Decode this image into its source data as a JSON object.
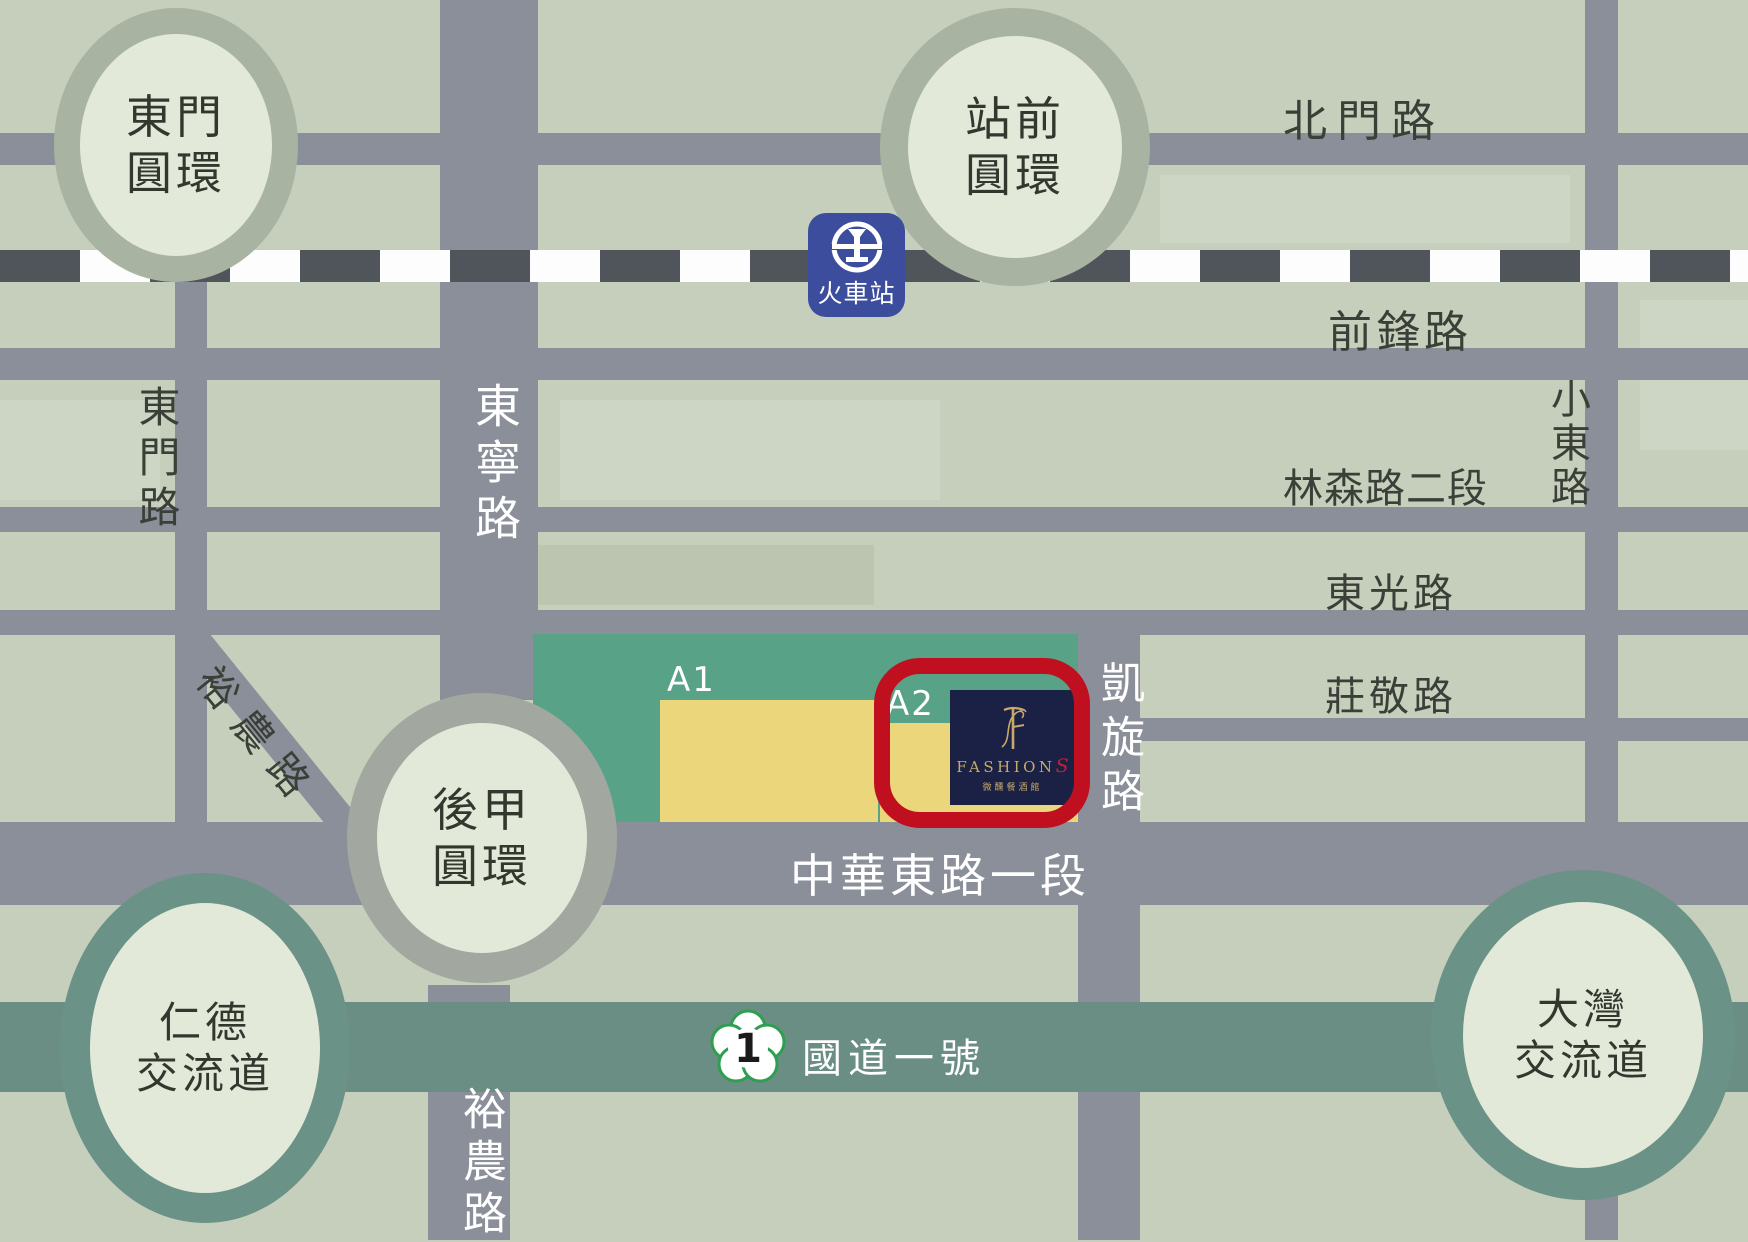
{
  "map_title": "FASHIONS hotel location map, Tainan",
  "colors": {
    "background": "#C6CFBC",
    "road_gray": "#8B8F99",
    "railway_dash": "#50555C",
    "highway_teal": "#6B8E84",
    "interchange_ring_teal": "#6B9287",
    "roundabout_ring": "#A9B3A2",
    "circle_inner": "#E3E9D9",
    "zone_teal": "#58A288",
    "building_yellow": "#ECD67B",
    "highlight_red": "#C0101F",
    "logo_navy": "#1A2144",
    "logo_gold": "#C9A96A",
    "station_blue": "#3C4D9E"
  },
  "roundabouts": {
    "dongmen": {
      "line1": "東門",
      "line2": "圓環"
    },
    "zhanqian": {
      "line1": "站前",
      "line2": "圓環"
    },
    "houjia": {
      "line1": "後甲",
      "line2": "圓環"
    },
    "rende": {
      "line1": "仁德",
      "line2": "交流道"
    },
    "dawan": {
      "line1": "大灣",
      "line2": "交流道"
    }
  },
  "road_labels": {
    "beimen": "北門路",
    "qianfeng": "前鋒路",
    "linsen": "林森路二段",
    "dongguang": "東光路",
    "zhuangjing": "莊敬路",
    "zhonghua": "中華東路一段",
    "dongmen_road": "東門路",
    "dongning": "東寧路",
    "xiaodong": "小東路",
    "kaixuan": "凱旋路",
    "yunong_diagonal": "裕農路",
    "yunong_south": "裕農路"
  },
  "highway": {
    "label": "國道一號",
    "number": "1"
  },
  "station": {
    "label": "火車站",
    "icon": "taiwan-railway-emblem"
  },
  "zone_labels": {
    "a1": "A1",
    "a2": "A2"
  },
  "hotel": {
    "brand": "FASHION",
    "brand_last_letter": "S",
    "monogram": "F",
    "subtitle": "微醺餐酒館"
  }
}
